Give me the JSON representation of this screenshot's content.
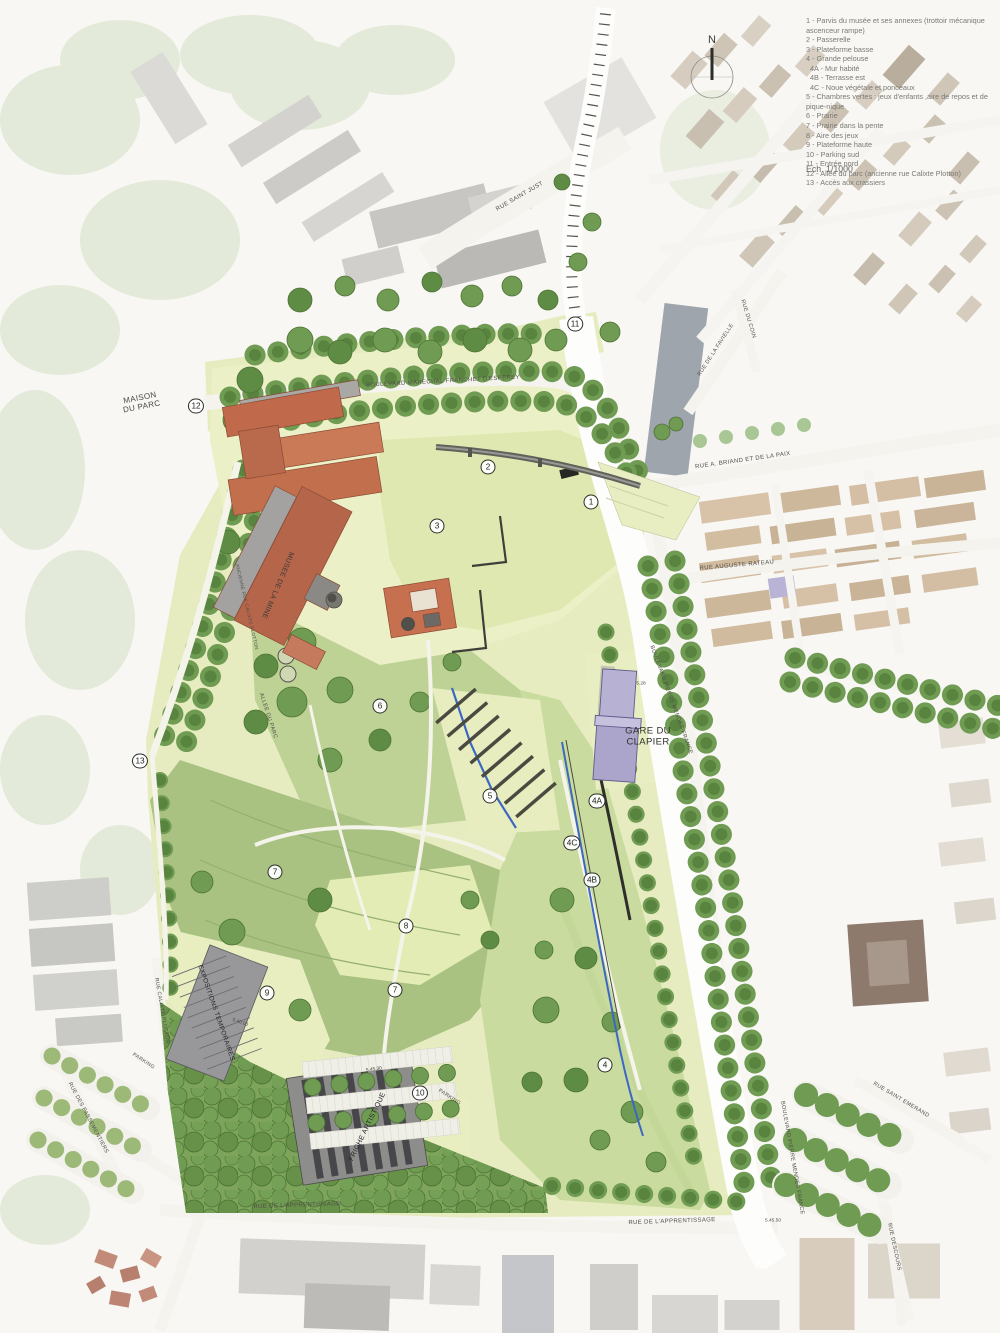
{
  "map": {
    "north_label": "N",
    "scale_label": "Ech. 1/1000"
  },
  "legend": {
    "items": [
      {
        "text": "1 - Parvis du musée et ses annexes (trottoir mécanique ascenceur rampe)"
      },
      {
        "text": "2 - Passerelle"
      },
      {
        "text": "3 - Plateforme basse"
      },
      {
        "text": "4 - Grande pelouse"
      },
      {
        "text": "4A - Mur habité",
        "indent": true
      },
      {
        "text": "4B - Terrasse est",
        "indent": true
      },
      {
        "text": "4C - Noue végétale et ponceaux",
        "indent": true
      },
      {
        "text": "5 - Chambres vertes : jeux d'enfants ,aire de repos et de pique-nique"
      },
      {
        "text": "6 - Prairie"
      },
      {
        "text": "7 - Prairie dans la pente"
      },
      {
        "text": "8 - Aire des jeux"
      },
      {
        "text": "9 - Plateforme haute"
      },
      {
        "text": "10 - Parking sud"
      },
      {
        "text": "11 - Entrée nord"
      },
      {
        "text": "12 - Allée du parc (ancienne rue Calixte Plotton)"
      },
      {
        "text": "13 - Accès aux crassiers"
      }
    ]
  },
  "markers": [
    {
      "label": "11",
      "x": 575,
      "y": 324
    },
    {
      "label": "12",
      "x": 196,
      "y": 406
    },
    {
      "label": "2",
      "x": 488,
      "y": 467
    },
    {
      "label": "1",
      "x": 591,
      "y": 502
    },
    {
      "label": "3",
      "x": 437,
      "y": 526
    },
    {
      "label": "13",
      "x": 140,
      "y": 761
    },
    {
      "label": "6",
      "x": 380,
      "y": 706
    },
    {
      "label": "5",
      "x": 490,
      "y": 796
    },
    {
      "label": "4A",
      "x": 597,
      "y": 801
    },
    {
      "label": "4C",
      "x": 572,
      "y": 843
    },
    {
      "label": "4B",
      "x": 592,
      "y": 880
    },
    {
      "label": "7",
      "x": 275,
      "y": 872
    },
    {
      "label": "8",
      "x": 406,
      "y": 926
    },
    {
      "label": "7",
      "x": 395,
      "y": 990
    },
    {
      "label": "9",
      "x": 267,
      "y": 993
    },
    {
      "label": "4",
      "x": 605,
      "y": 1065
    },
    {
      "label": "10",
      "x": 420,
      "y": 1093
    }
  ],
  "place_labels": [
    {
      "name": "street-label-rue-saint-just",
      "text": "RUE SAINT JUST",
      "x": 520,
      "y": 197,
      "rot": -30,
      "size": 6
    },
    {
      "name": "street-label-bd-franchet-desperey",
      "text": "BOULEVARD MARECHAL FRANCHET D'ESPEREY",
      "x": 443,
      "y": 382,
      "rot": -3,
      "size": 6
    },
    {
      "name": "street-label-rue-briand-paix",
      "text": "RUE A. BRIAND ET DE LA PAIX",
      "x": 743,
      "y": 461,
      "rot": -8,
      "size": 6
    },
    {
      "name": "street-label-rue-de-la-favielle",
      "text": "RUE DE LA FAVIELLE",
      "x": 716,
      "y": 350,
      "rot": -57,
      "size": 5.5
    },
    {
      "name": "street-label-rue-du-coin",
      "text": "RUE DU COIN",
      "x": 748,
      "y": 319,
      "rot": 73,
      "size": 5.5
    },
    {
      "name": "street-label-rue-auguste-rateau",
      "text": "RUE AUGUSTE RATEAU",
      "x": 737,
      "y": 566,
      "rot": -5,
      "size": 6
    },
    {
      "name": "maison-du-parc-label",
      "text": "MAISON\nDU PARC",
      "x": 141,
      "y": 403,
      "rot": -11,
      "size": 8,
      "color": "#4a4944"
    },
    {
      "name": "musee-de-la-mine-label",
      "text": "MUSEE DE LA MINE",
      "x": 277,
      "y": 585,
      "rot": 113,
      "size": 7,
      "color": "#3c3b36"
    },
    {
      "name": "gare-du-clapier-label",
      "text": "GARE DU\nCLAPIER",
      "x": 648,
      "y": 737,
      "rot": 0,
      "size": 9.5,
      "color": "#2f2f2b"
    },
    {
      "name": "street-label-bd-pierre-mendes-france-nord",
      "text": "BOULEVARD PIERRE MENDES FRANCE",
      "x": 671,
      "y": 700,
      "rot": 70,
      "size": 5.5
    },
    {
      "name": "allee-du-parc-label",
      "text": "ALLEE DU PARC",
      "x": 268,
      "y": 716,
      "rot": 72,
      "size": 5.5
    },
    {
      "name": "ancienne-rue-calixte-plotton-label",
      "text": "ANCIENNE RUE CALIXTE PLOTTON",
      "x": 247,
      "y": 607,
      "rot": 77,
      "size": 4.6
    },
    {
      "name": "expositions-temporaires-label",
      "text": "EXPOSITIONS TEMPORAIRES",
      "x": 216,
      "y": 1013,
      "rot": 71,
      "size": 6.5,
      "color": "#242428"
    },
    {
      "name": "friche-artistique-label",
      "text": "FRICHE ARTISTIQUE",
      "x": 368,
      "y": 1127,
      "rot": -64,
      "size": 7,
      "color": "#242428"
    },
    {
      "name": "street-label-rue-calixte-plotton",
      "text": "RUE CALIXTE PLOTTON",
      "x": 161,
      "y": 1011,
      "rot": 80,
      "size": 5.2
    },
    {
      "name": "street-label-rue-des-passementiers",
      "text": "RUE DES PASSEMENTIERS",
      "x": 88,
      "y": 1118,
      "rot": 62,
      "size": 5.5
    },
    {
      "name": "parking-ouest-label",
      "text": "PARKING",
      "x": 143,
      "y": 1062,
      "rot": 33,
      "size": 5.2
    },
    {
      "name": "parking-sud-label",
      "text": "PARKING",
      "x": 449,
      "y": 1098,
      "rot": 33,
      "size": 5.2
    },
    {
      "name": "street-label-rue-apprentissage-ouest",
      "text": "RUE DE L'APPRENTISSAGE",
      "x": 297,
      "y": 1206,
      "rot": -2,
      "size": 6
    },
    {
      "name": "street-label-rue-apprentissage-est",
      "text": "RUE DE L'APPRENTISSAGE",
      "x": 672,
      "y": 1222,
      "rot": -2,
      "size": 6
    },
    {
      "name": "street-label-bd-pierre-mendes-france-sud",
      "text": "BOULEVARD PIERRE MENDES FRANCE",
      "x": 792,
      "y": 1158,
      "rot": 80,
      "size": 5.5
    },
    {
      "name": "street-label-rue-saint-emerand",
      "text": "RUE SAINT EMERAND",
      "x": 901,
      "y": 1100,
      "rot": 31,
      "size": 5.5
    },
    {
      "name": "street-label-rue-descours",
      "text": "RUE DESCOURS",
      "x": 894,
      "y": 1247,
      "rot": 78,
      "size": 5.5
    }
  ],
  "elevation_labels": [
    {
      "text": "5.28",
      "x": 641,
      "y": 684,
      "rot": 0
    },
    {
      "text": "5.40.00",
      "x": 240,
      "y": 1023,
      "rot": 20
    },
    {
      "text": "5.45.30",
      "x": 374,
      "y": 1070,
      "rot": -8
    },
    {
      "text": "5.45.50",
      "x": 773,
      "y": 1221,
      "rot": 0
    }
  ],
  "colors": {
    "park_pale": "#e6ecc0",
    "meadow": "#bed295",
    "slope_green": "#a9c282",
    "lawn": "#c9db9e",
    "tree_green": "#6f9b52",
    "museum_roof": "#c26f4e",
    "station_purple": "#b7b1d4",
    "noue_blue": "#3d68c2",
    "legend_text": "#7b7974"
  }
}
